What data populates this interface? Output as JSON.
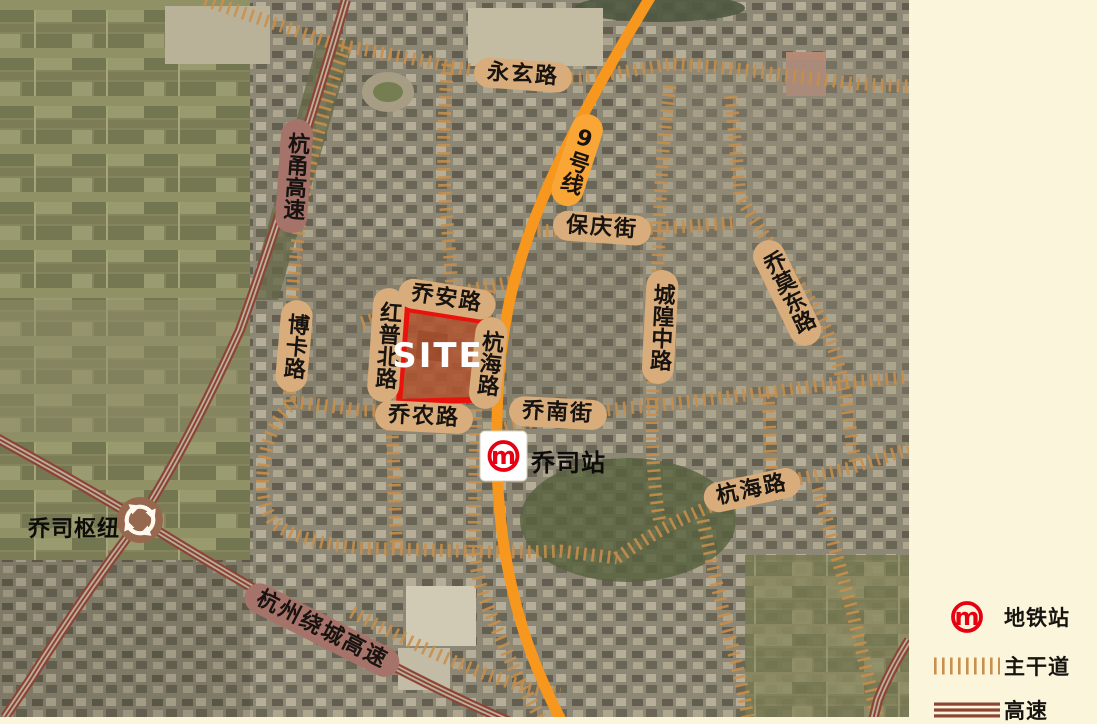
{
  "map": {
    "road_labels": [
      {
        "text": "永玄路"
      },
      {
        "text": "杭甬高速"
      },
      {
        "text": "9号线"
      },
      {
        "text": "保庆街"
      },
      {
        "text": "乔安路"
      },
      {
        "text": "红普北路"
      },
      {
        "text": "杭海路"
      },
      {
        "text": "博卡路"
      },
      {
        "text": "城隍中路"
      },
      {
        "text": "乔莫东路"
      },
      {
        "text": "乔农路"
      },
      {
        "text": "乔南街"
      },
      {
        "text": "杭海路"
      },
      {
        "text": "杭州绕城高速"
      }
    ],
    "site_label": "SITE",
    "station_label": "乔司站",
    "hub_label": "乔司枢纽",
    "metro_logo_letter": "m"
  },
  "legend": {
    "items": [
      {
        "label": "地铁站"
      },
      {
        "label": "主干道"
      },
      {
        "label": "高速"
      }
    ]
  },
  "colors": {
    "background_cream": "#FBF6DB",
    "metro_line_orange": "#F7971D",
    "metro_pill_orange": "#F9A637",
    "arterial_road_tan": "#C98F4B",
    "highway_red": "#8E4435",
    "label_pill_tan": "#D8AC7B",
    "label_pill_mauve": "#A5736A",
    "site_outline_red": "#E8130C",
    "metro_logo_red": "#E60012"
  }
}
